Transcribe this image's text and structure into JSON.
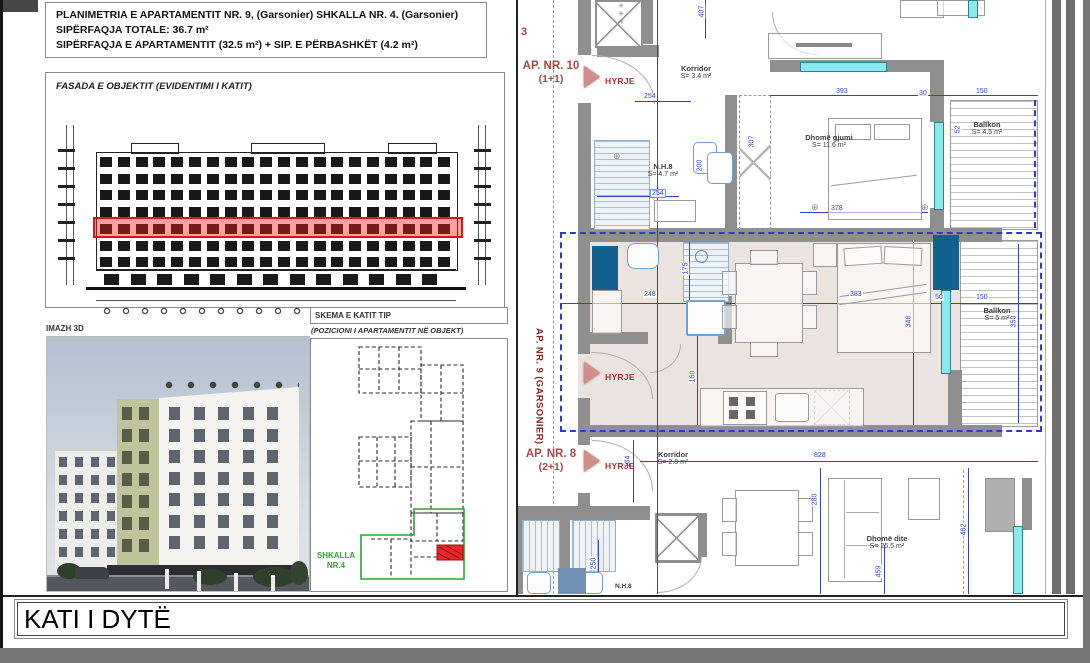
{
  "header": {
    "line1": "PLANIMETRIA E APARTAMENTIT NR. 9, (Garsonier) SHKALLA NR. 4. (Garsonier)",
    "line2": "SIPËRFAQJA TOTALE: 36.7 m²",
    "line3": "SIPËRFAQJA E APARTAMENTIT (32.5 m²) + SIP. E PËRBASHKËT (4.2 m²)"
  },
  "facade": {
    "label": "FASADA E OBJEKTIT (EVIDENTIMI I KATIT)"
  },
  "image3d": {
    "label": "IMAZH 3D"
  },
  "skema": {
    "title": "SKEMA E KATIT TIP",
    "subtitle": "(POZICIONI I APARTAMENTIT NË OBJEKT)",
    "shkalla_line1": "SHKALLA",
    "shkalla_line2": "NR.4"
  },
  "plan": {
    "grid_label": "3",
    "ap10": {
      "name": "AP. NR. 10",
      "type": "(1+1)",
      "entry": "HYRJE"
    },
    "ap9": {
      "name": "AP. NR. 9",
      "type": "(GARSONIER)",
      "entry": "HYRJE"
    },
    "ap8": {
      "name": "AP. NR. 8",
      "type": "(2+1)",
      "entry": "HYRJE"
    },
    "rooms": {
      "korridor10": {
        "name": "Korridor",
        "area": "S= 3.4 m²"
      },
      "nh8_10": {
        "name": "N.H.8",
        "area": "S= 4.7 m²"
      },
      "bedroom10": {
        "name": "Dhomë gjumi",
        "area": "S= 11.6 m²"
      },
      "balcony10": {
        "name": "Ballkon",
        "area": "S= 4.5 m²"
      },
      "balcony9": {
        "name": "Ballkon",
        "area": "S= 5 m²"
      },
      "korridor8": {
        "name": "Korridor",
        "area": "S= 2.8 m²"
      },
      "living8": {
        "name": "Dhomë dite",
        "area": "S= 25.5 m²"
      },
      "nh8_8": {
        "name": "N.H.8"
      }
    },
    "dims": {
      "d254a": "254",
      "d393": "393",
      "d30": "30",
      "d150a": "150",
      "d307": "307",
      "d200": "200",
      "d254b": "254",
      "d378": "378",
      "d52": "52",
      "d407": "407",
      "d248": "248",
      "d175": "175",
      "d383": "383",
      "d346": "346",
      "d50": "50",
      "d150b": "150",
      "d350": "350",
      "d160": "160",
      "d134": "134",
      "d828": "828",
      "d250": "250",
      "d280": "280",
      "d462": "462",
      "d459": "459"
    }
  },
  "footer": {
    "title": "KATI I DYTË"
  }
}
